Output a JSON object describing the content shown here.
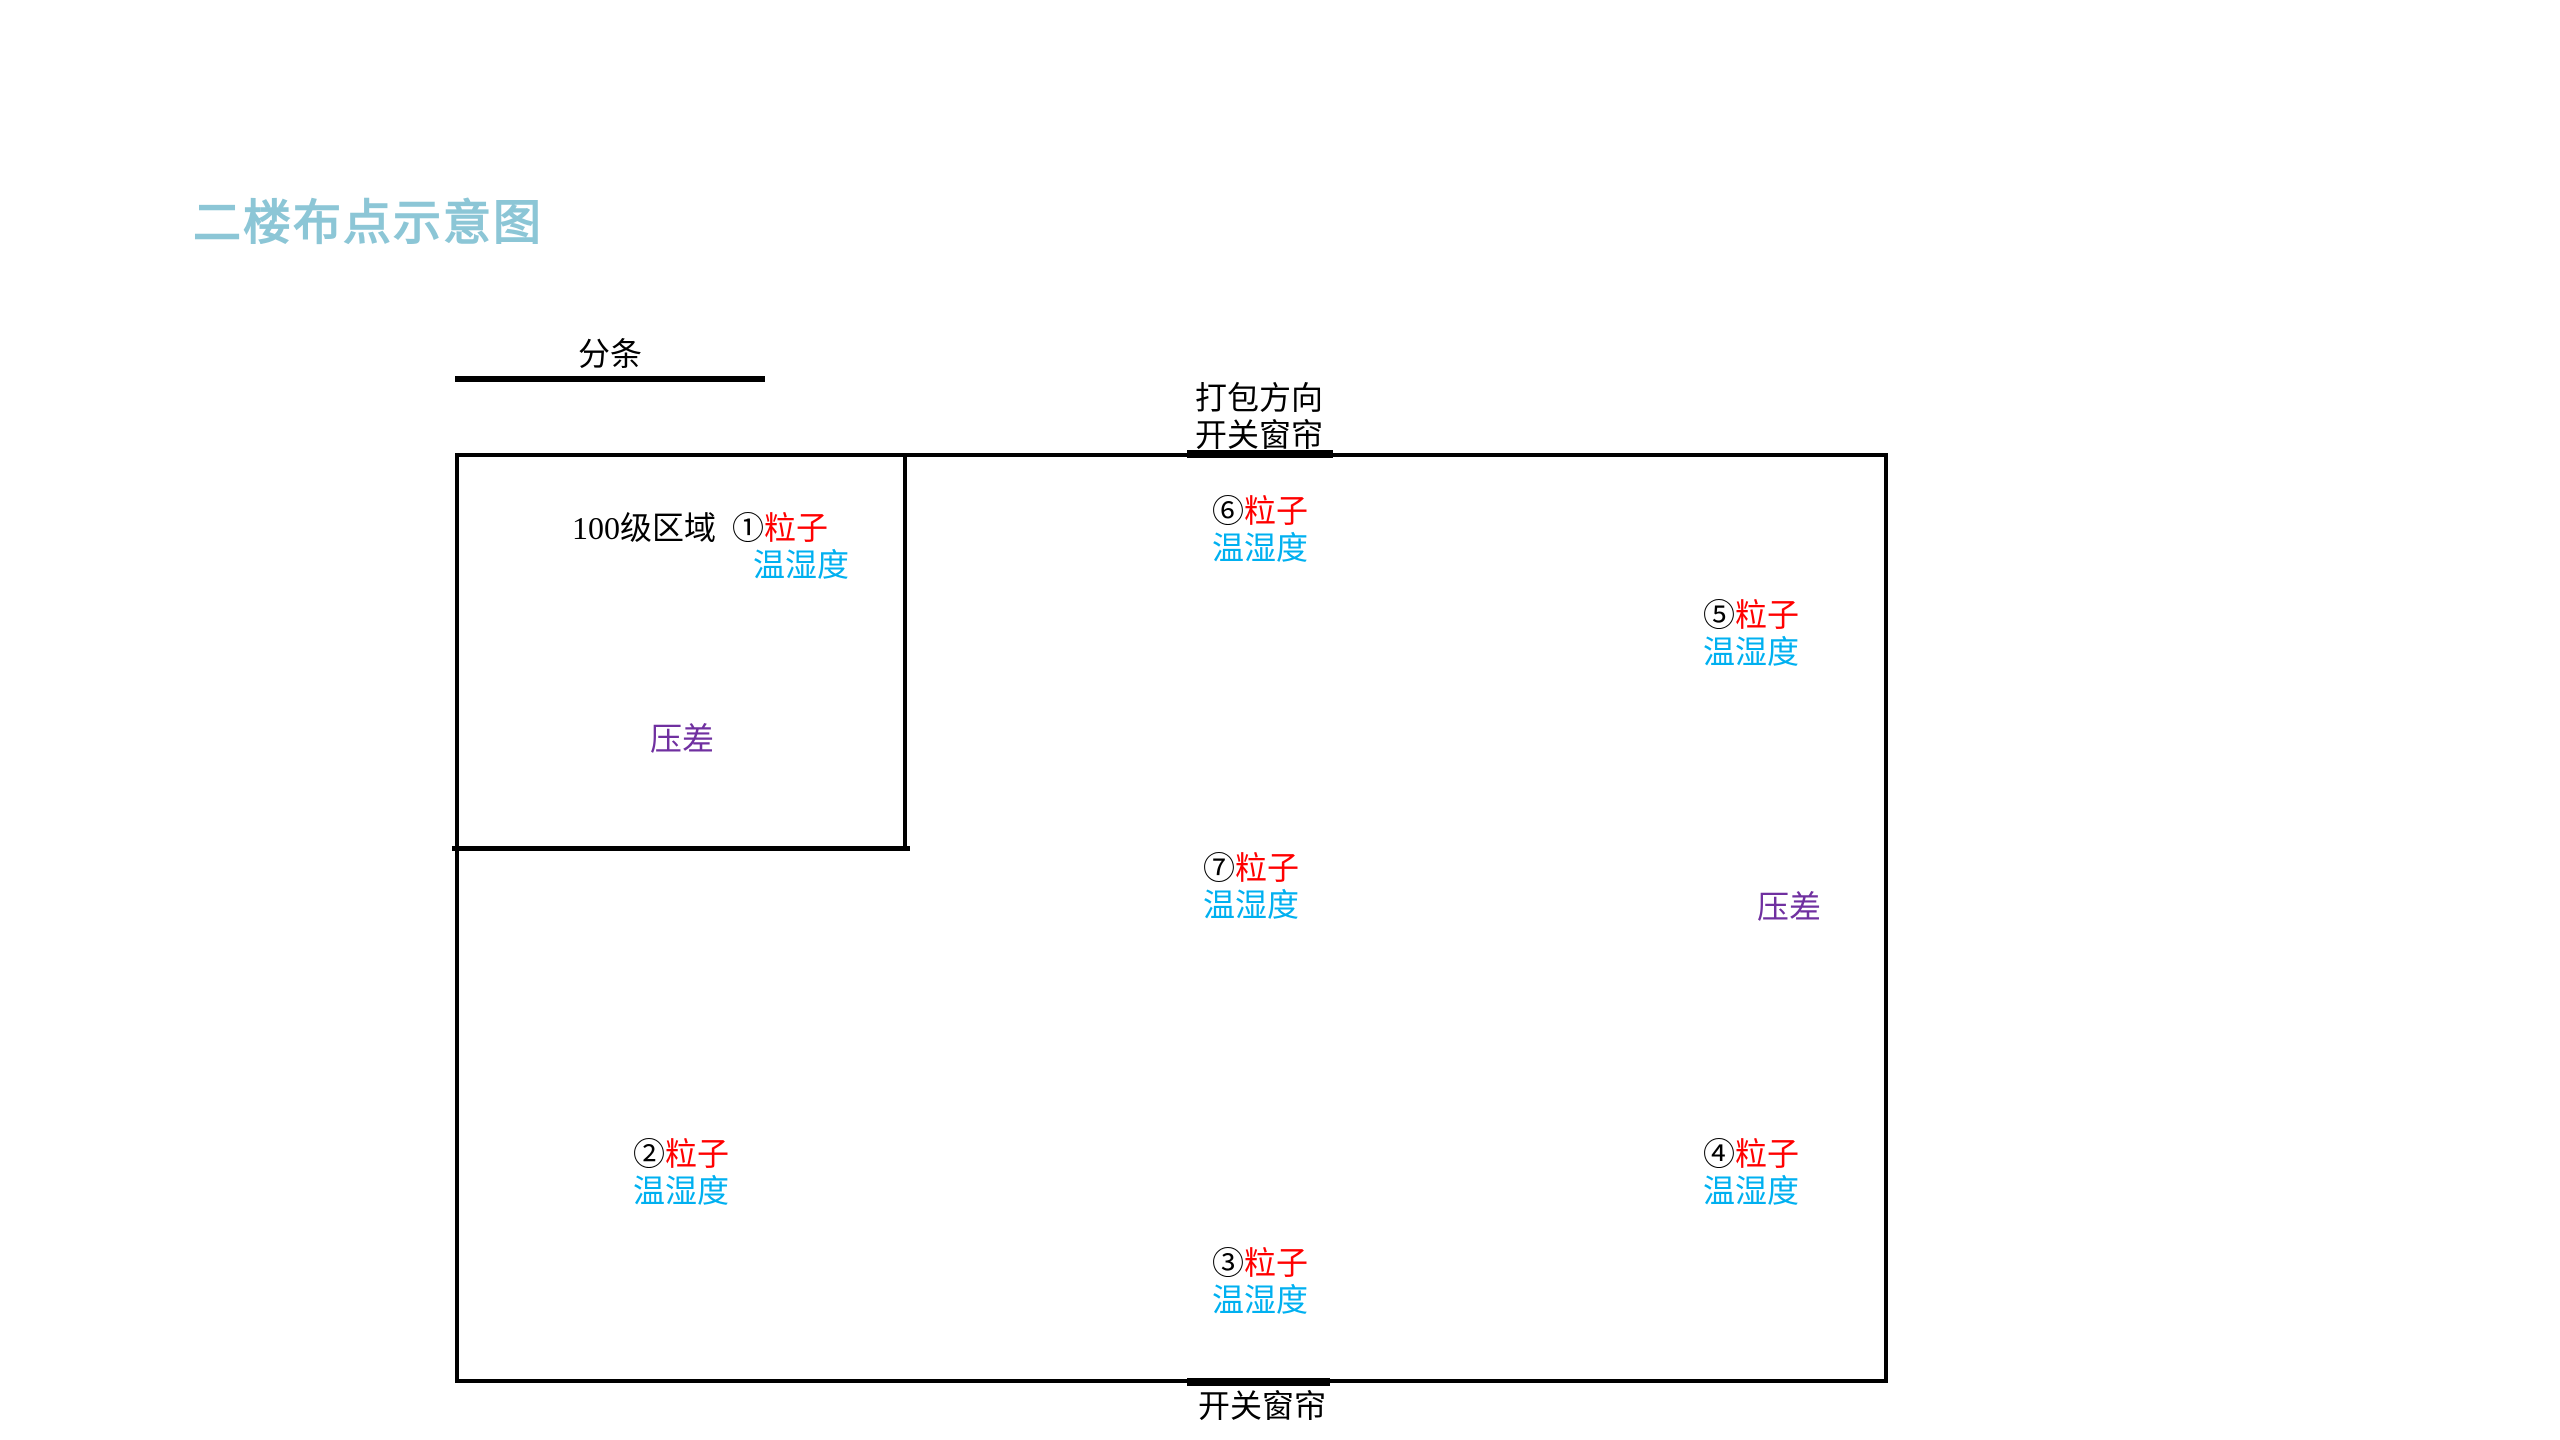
{
  "title": {
    "text": "二楼布点示意图",
    "color": "#8CC6D6"
  },
  "colors": {
    "particle": "#FF0000",
    "temp_humidity": "#00B0F0",
    "pressure_diff": "#7030A0",
    "wall": "#000000"
  },
  "annotations": {
    "strip_label": "分条",
    "packing_direction": "打包方向",
    "curtain_top": "开关窗帘",
    "curtain_bottom": "开关窗帘"
  },
  "clean_area": {
    "label": "100级区域",
    "pressure_label": "压差"
  },
  "pressure_right_label": "压差",
  "points": [
    {
      "marker": "①",
      "name": "粒子",
      "secondary": "温湿度"
    },
    {
      "marker": "②",
      "name": "粒子",
      "secondary": "温湿度"
    },
    {
      "marker": "③",
      "name": "粒子",
      "secondary": "温湿度"
    },
    {
      "marker": "④",
      "name": "粒子",
      "secondary": "温湿度"
    },
    {
      "marker": "⑤",
      "name": "粒子",
      "secondary": "温湿度"
    },
    {
      "marker": "⑥",
      "name": "粒子",
      "secondary": "温湿度"
    },
    {
      "marker": "⑦",
      "name": "粒子",
      "secondary": "温湿度"
    }
  ]
}
